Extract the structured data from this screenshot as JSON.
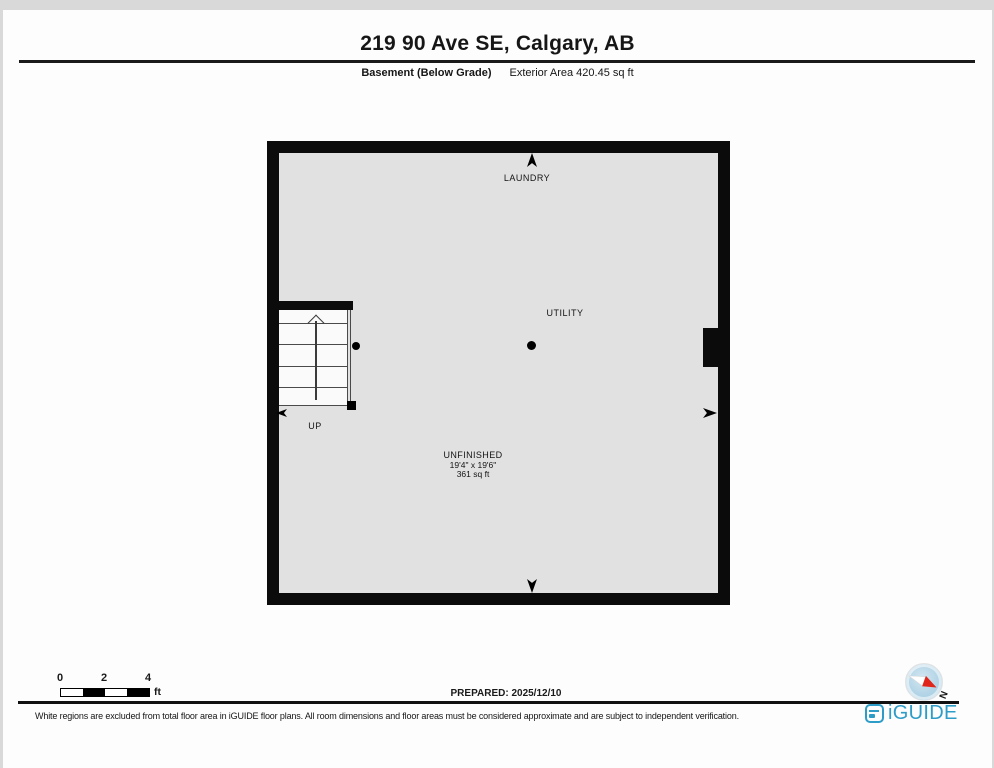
{
  "header": {
    "title": "219 90 Ave SE, Calgary, AB",
    "floor_label": "Basement (Below Grade)",
    "area_label": "Exterior Area 420.45 sq ft"
  },
  "plan": {
    "rooms": [
      {
        "name": "LAUNDRY"
      },
      {
        "name": "UTILITY"
      },
      {
        "name": "UNFINISHED",
        "dimensions": "19'4\" x 19'6\"",
        "area": "361 sq ft"
      }
    ],
    "stairs_label": "UP"
  },
  "scale_bar": {
    "ticks": [
      "0",
      "2",
      "4"
    ],
    "unit": "ft"
  },
  "prepared_label": "PREPARED: 2025/12/10",
  "compass": {
    "north_label": "N"
  },
  "footer": {
    "disclaimer": "White regions are excluded from total floor area in iGUIDE floor plans. All room dimensions and floor areas must be considered approximate and are subject to independent verification.",
    "brand": "iGUIDE"
  },
  "colors": {
    "brand_blue": "#2d9dc8",
    "compass_red": "#e0251b",
    "room_fill": "#e1e1e1",
    "wall": "#0b0b0b"
  }
}
